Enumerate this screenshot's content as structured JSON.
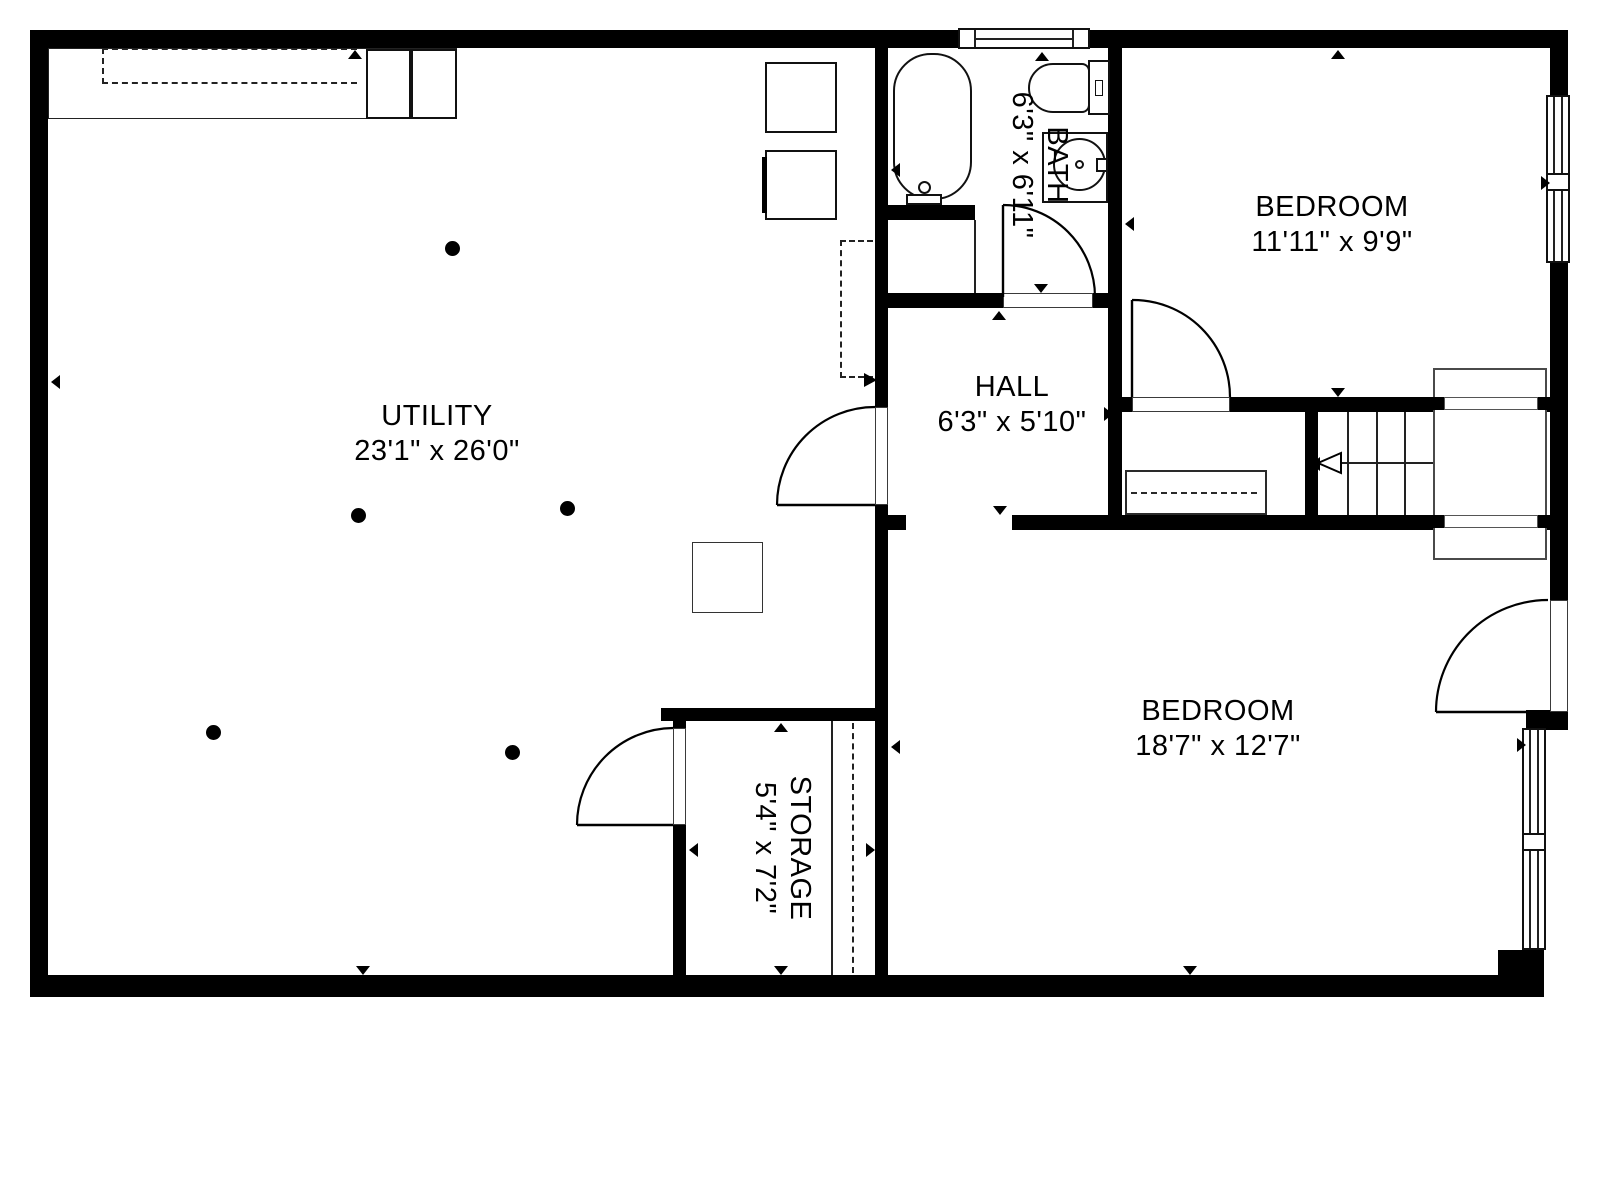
{
  "rooms": {
    "utility": {
      "name": "UTILITY",
      "dims": "23'1\" x 26'0\""
    },
    "bath": {
      "name": "BATH",
      "dims": "6'3\" x 6'11\""
    },
    "hall": {
      "name": "HALL",
      "dims": "6'3\" x 5'10\""
    },
    "bedroom1": {
      "name": "BEDROOM",
      "dims": "11'11\" x 9'9\""
    },
    "bedroom2": {
      "name": "BEDROOM",
      "dims": "18'7\" x 12'7\""
    },
    "storage": {
      "name": "STORAGE",
      "dims": "5'4\" x 7'2\""
    }
  },
  "colors": {
    "wall": "#000000",
    "line": "#2a2a2a",
    "thin": "#3a3a3a",
    "landing": "#4a4a4a",
    "background": "#ffffff"
  }
}
